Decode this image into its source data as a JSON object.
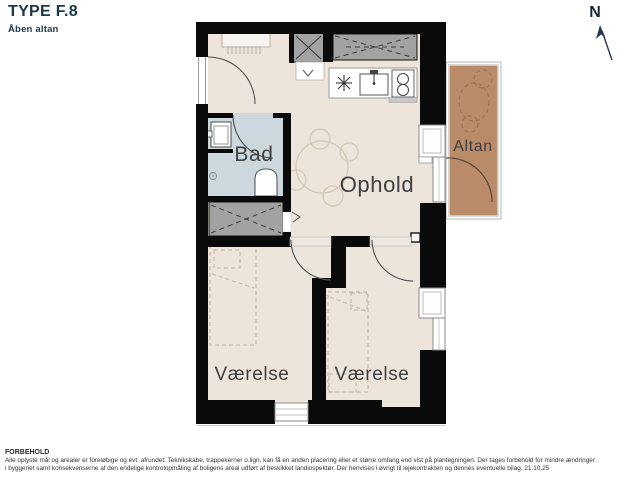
{
  "header": {
    "title": "TYPE F.8",
    "subtitle": "Åben altan"
  },
  "compass": {
    "label": "N"
  },
  "rooms": {
    "bath": "Bad",
    "living": "Ophold",
    "balcony": "Altan",
    "bedroom1": "Værelse",
    "bedroom2": "Værelse"
  },
  "footer": {
    "heading": "FORBEHOLD",
    "line1": "Alle oplyste mål og arealer er foreløbige og evt. afrundet. Teknikskabe, trappekerner o.lign. kan få en anden placering eller et større omfang end vist på plantegningen. Der tages forbehold for mindre ændringer",
    "line2": "i byggeriet samt konsekvenserne af den endelige kontrolopmåling af boligens areal udført af beskikket landinspektør. Der henvises i øvrigt til lejekontrakten og dennes eventuelle bilag. 21.10.25"
  },
  "colors": {
    "accent_navy": "#1b3749",
    "wall_black": "#0a0a0a",
    "floor_beige": "#ede4db",
    "bathroom_blue": "#ccd7de",
    "balcony_brown": "#b98b69",
    "technical_gray": "#a2a2a2",
    "label_gray": "#3f3f3f"
  }
}
